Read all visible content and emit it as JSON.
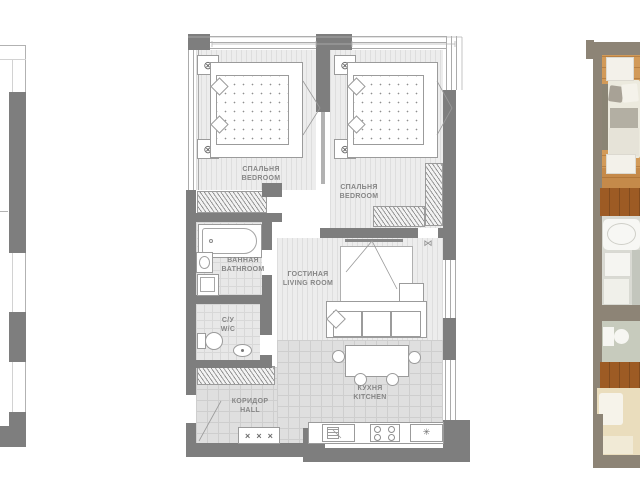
{
  "rooms": {
    "bedroom1": {
      "ru": "СПАЛЬНЯ",
      "en": "BEDROOM"
    },
    "bedroom2": {
      "ru": "СПАЛЬНЯ",
      "en": "BEDROOM"
    },
    "bathroom": {
      "ru": "ВАННАЯ",
      "en": "BATHROOM"
    },
    "living": {
      "ru": "ГОСТИНАЯ",
      "en": "LIVING ROOM"
    },
    "wc": {
      "ru": "С/У",
      "en": "W/C"
    },
    "hall": {
      "ru": "КОРИДОР",
      "en": "HALL"
    },
    "kitchen": {
      "ru": "КУХНЯ",
      "en": "KITCHEN"
    }
  },
  "icons": {
    "ceiling_light": "⊗",
    "wall_fan": "⋈",
    "fridge_snowflake": "✳",
    "closet_cross": "×"
  },
  "colors": {
    "wall_gray": "#7e7e7e",
    "line_gray": "#a8a8a8",
    "label_gray": "#868686",
    "render_wall_taupe": "#8d8476",
    "render_wood_floor": "#d29a58",
    "render_wardrobe_brown": "#9d5b24"
  }
}
